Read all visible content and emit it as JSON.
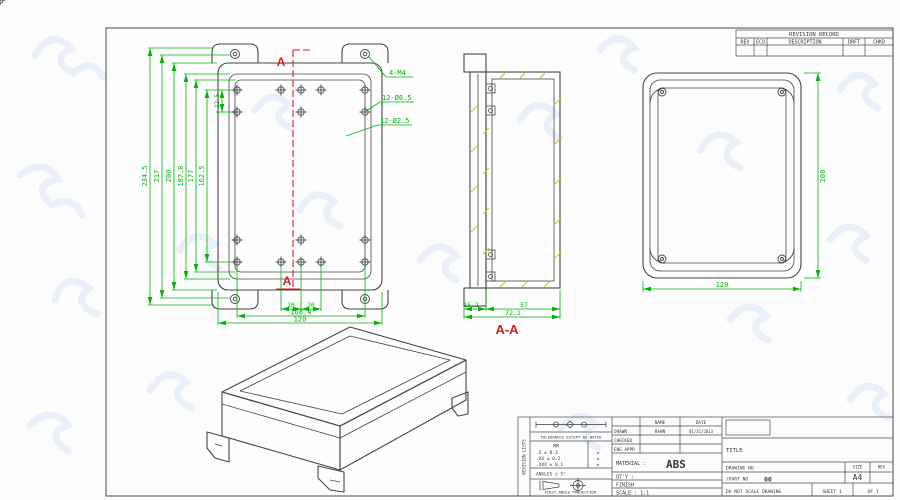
{
  "colors": {
    "line": "#454545",
    "dim": "#00b400",
    "section_red": "#d32019",
    "hatch": "#cfc21d",
    "watermark": "#dfeaf7"
  },
  "revision_table": {
    "title": "REVISION RECORD",
    "columns": [
      "REV",
      "ECO",
      "DESCRIPTION",
      "DRFT",
      "CHKD"
    ]
  },
  "front_view": {
    "section_marker": "A",
    "callouts": {
      "corner": "4-M4",
      "large_holes": "12-Ø6.5",
      "small_holes": "12-Ø2.5"
    },
    "height_dims": [
      "234.5",
      "217",
      "200",
      "187.8",
      "177",
      "162.5"
    ],
    "screw_offset_dim": "22.5",
    "bottom_dims": {
      "pitch_left": "20",
      "pitch_right": "20",
      "hole_span": "108.4",
      "width": "120"
    }
  },
  "section_view": {
    "label": "A-A",
    "dims": {
      "lid": "15.2",
      "body": "57",
      "overall": "72.2"
    }
  },
  "back_view": {
    "height": "200",
    "width": "120"
  },
  "title_block": {
    "side_strip": "REVISION LISTS",
    "tolerances": {
      "heading": "TOLERANCES EXCEPT AS NOTED",
      "unit": "MM",
      "rows": [
        ".X ± 0.3",
        ".XX ± 0.2",
        ".XXX ± 0.1"
      ],
      "secondary_marks": [
        "±",
        "±",
        "±"
      ],
      "angles": "ANGLES ± 5°",
      "projection": "FIRST ANGLE PROJECTION"
    },
    "approvals": {
      "name_header": "NAME",
      "date_header": "DATE",
      "drawn_label": "DRAWN",
      "drawn_name": "RAWN",
      "drawn_date": "01/31/2013",
      "checked_label": "CHECKED",
      "eng_appr_label": "ENG APPR"
    },
    "material_label": "MATERIAL :",
    "material_value": "ABS",
    "qty_label": "QT'Y :",
    "finish_label": "FINISH",
    "scale_label": "SCALE : 1:1",
    "title_label": "TITLE",
    "drawing_no_label": "DRAWING NO",
    "part_no_label": "/PART NO",
    "part_no_value": "00",
    "size_label": "SIZE",
    "size_value": "A4",
    "rev_label": "REV",
    "do_not_scale": "DO NOT SCALE DRAWING",
    "sheet_label": "SHEET 1",
    "of_label": "OF 1"
  }
}
